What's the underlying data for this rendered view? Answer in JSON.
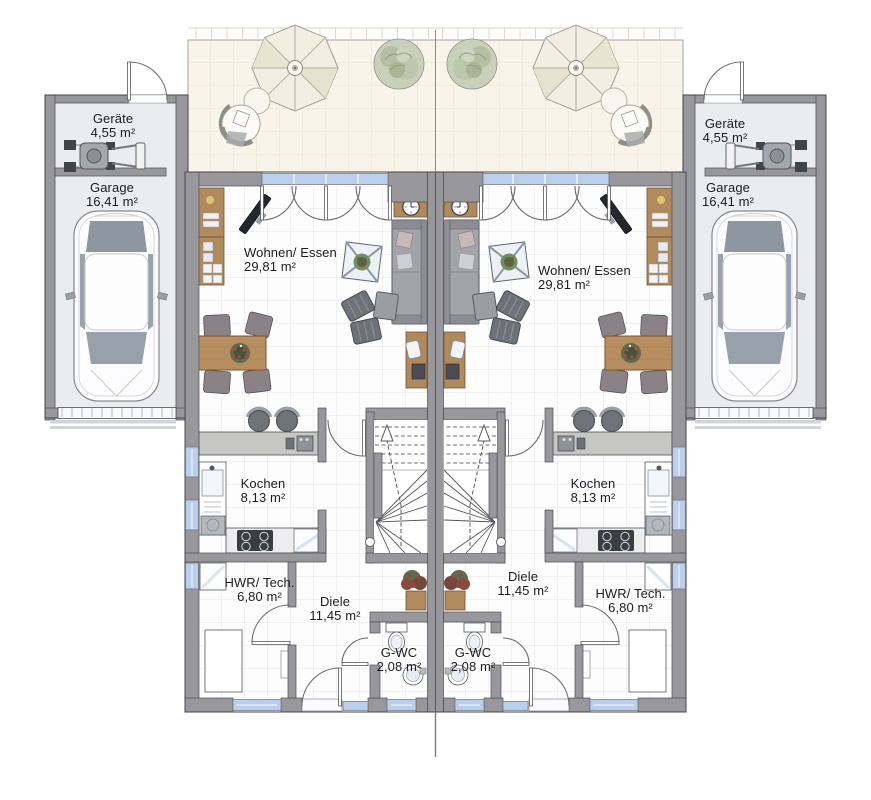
{
  "plan": {
    "title": "Erdgeschoss Doppelhaus Grundriss",
    "rooms": [
      {
        "unit": "left",
        "name": "Geräte",
        "area": "4,55 m²"
      },
      {
        "unit": "left",
        "name": "Garage",
        "area": "16,41 m²"
      },
      {
        "unit": "left",
        "name": "Wohnen/ Essen",
        "area": "29,81 m²"
      },
      {
        "unit": "left",
        "name": "Kochen",
        "area": "8,13 m²"
      },
      {
        "unit": "left",
        "name": "HWR/ Tech.",
        "area": "6,80 m²"
      },
      {
        "unit": "left",
        "name": "Diele",
        "area": "11,45 m²"
      },
      {
        "unit": "left",
        "name": "G-WC",
        "area": "2,08 m²"
      },
      {
        "unit": "right",
        "name": "Geräte",
        "area": "4,55 m²"
      },
      {
        "unit": "right",
        "name": "Garage",
        "area": "16,41 m²"
      },
      {
        "unit": "right",
        "name": "Wohnen/ Essen",
        "area": "29,81 m²"
      },
      {
        "unit": "right",
        "name": "Kochen",
        "area": "8,13 m²"
      },
      {
        "unit": "right",
        "name": "Diele",
        "area": "11,45 m²"
      },
      {
        "unit": "right",
        "name": "HWR/ Tech.",
        "area": "6,80 m²"
      },
      {
        "unit": "right",
        "name": "G-WC",
        "area": "2,08 m²"
      }
    ],
    "colors": {
      "wall_gray": "#98989c",
      "window_blue": "#b9cfec",
      "terrace_cream": "#f8f4e9",
      "floor_white": "#fdfdfe",
      "garage_floor": "#eaecf0",
      "wood": "#b08a5d",
      "sofa_gray": "#a2a4a9"
    }
  }
}
